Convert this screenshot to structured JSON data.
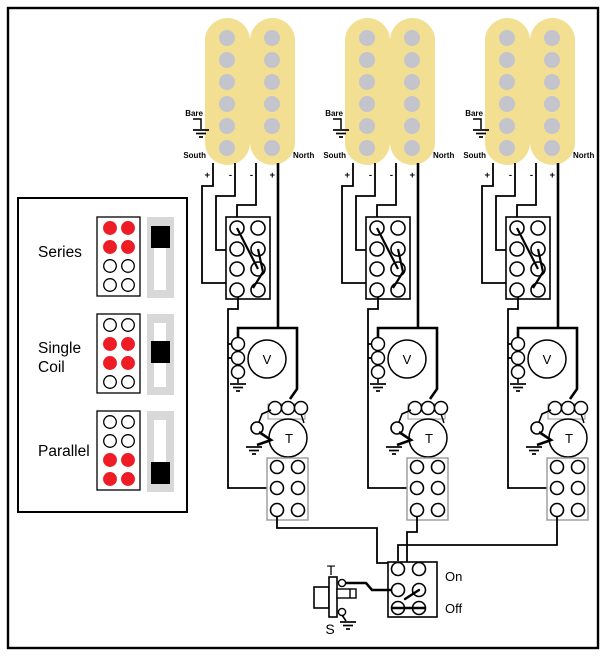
{
  "legend": {
    "items": [
      {
        "label": "Series",
        "label_lines": [
          "Series"
        ],
        "switch_position": "top",
        "active_rows": [
          1,
          2
        ]
      },
      {
        "label": "Single Coil",
        "label_lines": [
          "Single",
          "Coil"
        ],
        "switch_position": "middle",
        "active_rows": [
          2,
          3
        ]
      },
      {
        "label": "Parallel",
        "label_lines": [
          "Parallel"
        ],
        "switch_position": "bottom",
        "active_rows": [
          3,
          4
        ]
      }
    ]
  },
  "pickup_count": 3,
  "pickup_labels": {
    "bare": "Bare",
    "south": "South",
    "north": "North"
  },
  "terminals": [
    "+",
    "-",
    "-",
    "+"
  ],
  "pots": {
    "volume_label": "V",
    "tone_label": "T"
  },
  "output_jack": {
    "tip_label": "T",
    "sleeve_label": "S"
  },
  "kill_switch": {
    "on_label": "On",
    "off_label": "Off"
  },
  "colors": {
    "coil": "#F2DF92",
    "pole": "#C3C4CC",
    "red": "#EE1C25",
    "slider_track": "#D8D8D8",
    "block_stroke": "#999999",
    "pot_casing": "#AAAAAA",
    "line": "#000000",
    "background": "#FFFFFF"
  }
}
